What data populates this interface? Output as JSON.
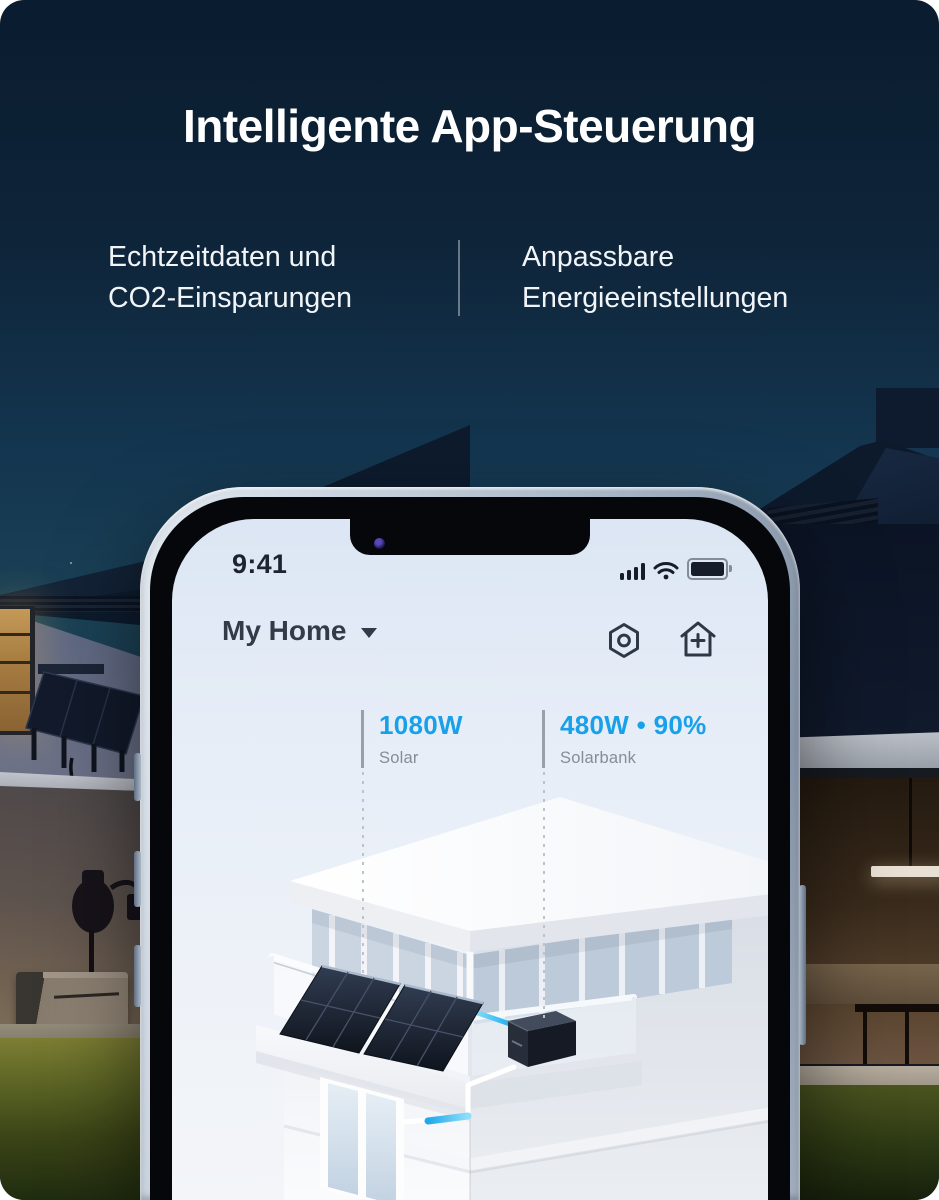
{
  "header": {
    "title": "Intelligente App-Steuerung",
    "features": [
      {
        "lines": [
          "Echtzeitdaten und",
          "CO2-Einsparungen"
        ]
      },
      {
        "lines": [
          "Anpassbare",
          "Energieeinstellungen"
        ]
      }
    ]
  },
  "phone": {
    "status_bar": {
      "time": "9:41",
      "icons": [
        "cellular-signal",
        "wifi",
        "battery"
      ]
    },
    "app_header": {
      "home_name": "My Home",
      "icons": [
        "settings-nut",
        "add-home"
      ]
    },
    "metrics": [
      {
        "value": "1080W",
        "label": "Solar"
      },
      {
        "value": "480W • 90%",
        "label": "Solarbank"
      }
    ],
    "illustration": "balcony-solar-panels-with-solarbank"
  },
  "scene": {
    "background": "night-house-with-solar-panels",
    "elements": [
      "left-house-lit-window",
      "wall-mounted-solar-awning",
      "portable-power-station",
      "right-house-warm-interior",
      "lawn"
    ]
  },
  "colors": {
    "accent_blue": "#18A0E8",
    "metric_label_gray": "#878D96",
    "headline_white": "#FFFFFF",
    "sky_top": "#0A1C2F",
    "sky_teal": "#1B4257",
    "screen_bg": "#E6EDF7",
    "app_text_dark": "#333B48"
  }
}
